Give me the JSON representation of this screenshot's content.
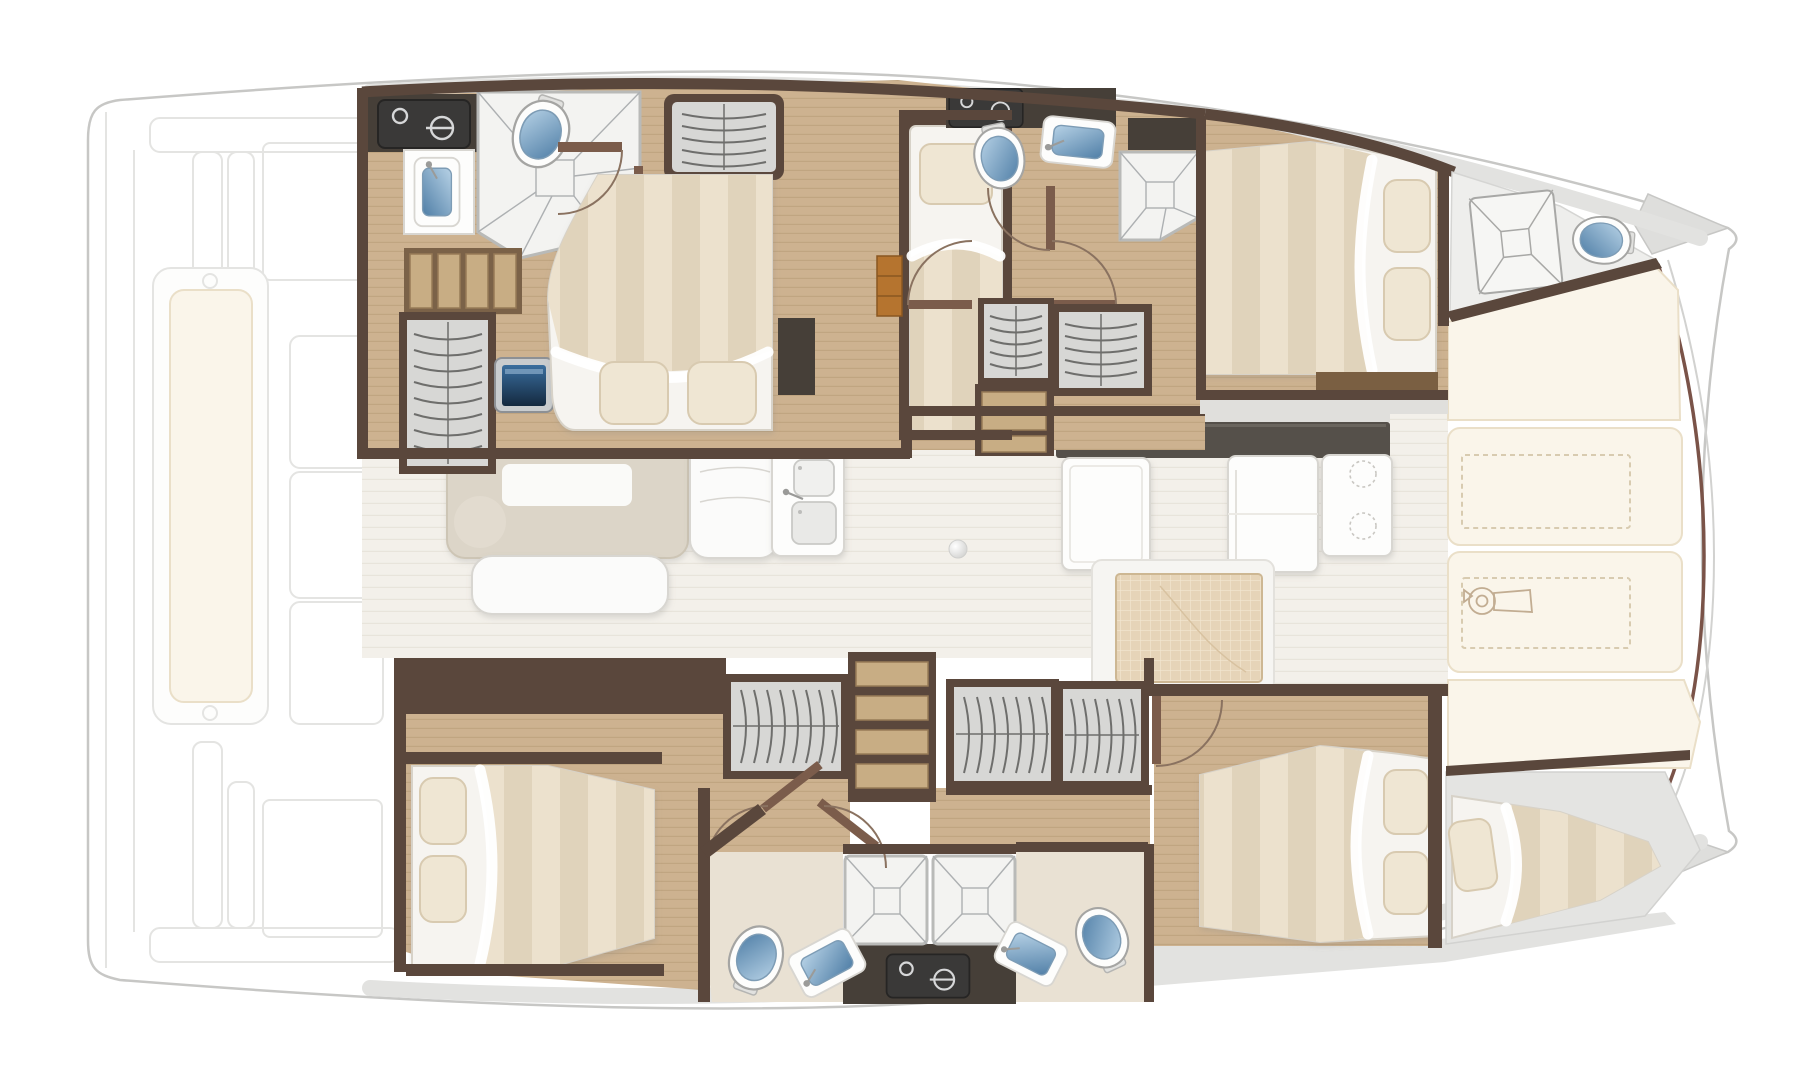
{
  "diagram": {
    "kind": "yacht-floor-plan",
    "vessel": "catamaran",
    "view": "top-down-interior-deck-plan"
  },
  "palette": {
    "hullFill": "#ffffff",
    "hullLine": "#c7c7c5",
    "faint": "#e4e4e2",
    "deckGray": "#e2e2e0",
    "grayBand": "#e0dfdc",
    "wall": "#5a473c",
    "cab": "#463f38",
    "appliance": "#3a3938",
    "applianceIcon": "#d6d7d8",
    "wood": "#cdb290",
    "woodLine": "#b59a74",
    "slat": "#c8ad84",
    "slatEdge": "#977b57",
    "stepGap": "#7b6248",
    "closet": "#d7d7d5",
    "closetLine": "#6e6e6c",
    "tile": "#f3f3f1",
    "tileLine": "#adb0b2",
    "silver": "#b9bab8",
    "bath": "#e9e1d3",
    "fixtureWhite": "#fdfdfc",
    "blueLight": "#b7d2e6",
    "blueDark": "#4f7ea6",
    "screenLight": "#3a6e9e",
    "screenDark": "#14293f",
    "mattressBase": "#f6f4f0",
    "mattressEdge": "#d7d2c8",
    "stripeA": "#ece1cd",
    "stripeB": "#e0d3bb",
    "pillow": "#efe6d3",
    "pillowEdge": "#d8cab0",
    "salonFloor": "#f3f0ea",
    "salonLine": "#e4dfd5",
    "tableBody": "#dcd5c8",
    "tableEdge": "#cdc5b5",
    "tableTop": "#fafaf8",
    "sofa": "#fbfbfa",
    "sofaEdge": "#d8d6d1",
    "cream": "#faf5ea",
    "creamEdge": "#eadfc8",
    "dashLine": "#d8cbb0",
    "sketch": "#c2ad92",
    "consoleDark": "#55504a",
    "mat": "#e6d4b8",
    "matLine": "#f2e7d2",
    "matEdge": "#cdb793",
    "doorArc": "#8a7260",
    "doorLeaf": "#7b5c4b",
    "orange": "#b5742f",
    "orangeEdge": "#8a5620",
    "boardWood": "#7a5f42",
    "bowBrown": "#7a5348"
  },
  "regions": {
    "aft_cockpit": {
      "name": "aft-cockpit",
      "fixtures": [
        "bench-seat-cushion",
        "seat-modules",
        "targa-bar",
        "transom-platform"
      ]
    },
    "port_hull": {
      "name": "port-hull",
      "rooms": [
        {
          "name": "aft-head",
          "fixtures": [
            "washing-machine",
            "washbasin",
            "shower",
            "toilet",
            "storage-steps",
            "wardrobe",
            "tv-screen",
            "bench"
          ]
        },
        {
          "name": "owner-cabin",
          "fixtures": [
            "double-bed",
            "pillows",
            "wardrobe",
            "nightstand",
            "door"
          ]
        },
        {
          "name": "single-berth-room",
          "fixtures": [
            "single-bed",
            "pillow",
            "shelf-unit"
          ]
        },
        {
          "name": "forward-head",
          "fixtures": [
            "washing-machine",
            "toilet",
            "washbasin",
            "shower",
            "doors",
            "companionway-steps",
            "wardrobe"
          ]
        },
        {
          "name": "forward-cabin",
          "fixtures": [
            "double-bed",
            "pillows",
            "shower",
            "cabinet",
            "footboard"
          ]
        },
        {
          "name": "forepeak",
          "fixtures": [
            "deck-hatch",
            "marine-toilet"
          ]
        }
      ]
    },
    "salon": {
      "name": "salon-bridgedeck",
      "fixtures": [
        "dinette-table",
        "table-top-pad",
        "sofa-bench",
        "l-sofa",
        "galley-double-sink",
        "refrigerator",
        "galley-counter",
        "stove-two-burners",
        "floor-mat",
        "helm-console",
        "door-knob"
      ]
    },
    "foredeck": {
      "name": "foredeck",
      "fixtures": [
        "cream-deck-panels",
        "locker-hatch-outlines",
        "windlass",
        "bow-rollers"
      ]
    },
    "starboard_hull": {
      "name": "starboard-hull",
      "rooms": [
        {
          "name": "aft-cabin",
          "fixtures": [
            "double-bed",
            "pillows",
            "wardrobe",
            "doors"
          ]
        },
        {
          "name": "wardrobe-corridor",
          "fixtures": [
            "wardrobe",
            "storage-shelves",
            "wardrobe",
            "wardrobe"
          ]
        },
        {
          "name": "twin-heads",
          "fixtures": [
            "toilet",
            "washbasin",
            "shower",
            "shower",
            "washing-machine",
            "washbasin",
            "toilet"
          ]
        },
        {
          "name": "forward-cabin",
          "fixtures": [
            "double-bed",
            "pillows",
            "door"
          ]
        },
        {
          "name": "bow-berth",
          "fixtures": [
            "tapered-berth",
            "pillow"
          ]
        }
      ]
    },
    "totals": {
      "double_beds": 4,
      "single_berths": 2,
      "toilets": 5,
      "showers": 4,
      "washbasins": 5,
      "washing_machines": 3
    }
  }
}
